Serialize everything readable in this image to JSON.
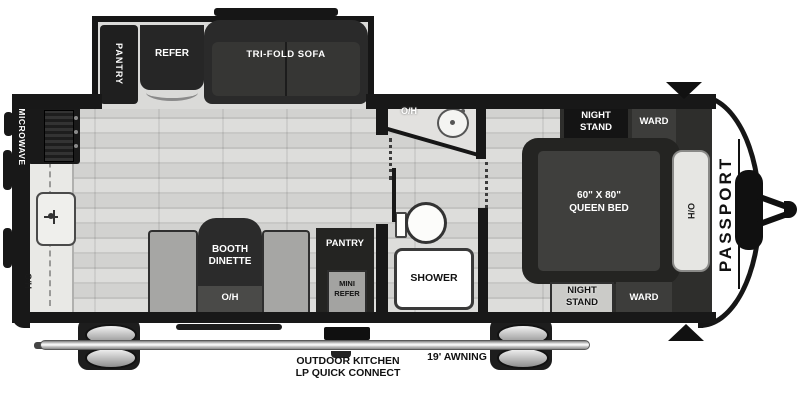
{
  "title": "Travel trailer floor plan",
  "exterior": {
    "brand": "PASSPORT",
    "awning": "19' AWNING"
  },
  "slideout": {
    "pantry": "PANTRY",
    "refer": "REFER",
    "sofa": "TRI-FOLD SOFA"
  },
  "kitchen": {
    "microwave": "MICROWAVE",
    "overhead": "O/H"
  },
  "dinette": {
    "line1": "BOOTH",
    "line2": "DINETTE",
    "overhead": "O/H"
  },
  "outdoor_kitchen": {
    "pantry": "PANTRY",
    "mini_refer_line1": "MINI",
    "mini_refer_line2": "REFER",
    "griddle": "GRIDDLE",
    "caption_line1": "OUTDOOR KITCHEN",
    "caption_line2": "LP QUICK CONNECT"
  },
  "bathroom": {
    "overhead": "O/H",
    "shower": "SHOWER"
  },
  "bedroom": {
    "night_stand_top_line1": "NIGHT",
    "night_stand_top_line2": "STAND",
    "ward_top": "WARD",
    "bed_line1": "60\" X 80\"",
    "bed_line2": "QUEEN BED",
    "overhead": "O/H",
    "night_stand_bottom_line1": "NIGHT",
    "night_stand_bottom_line2": "STAND",
    "ward_bottom": "WARD"
  },
  "colors": {
    "wall": "#181818",
    "furniture_dark": "#2b2b2b",
    "floor": "#d6d6d4",
    "counter": "#e9e9e6",
    "bench_gray": "#a6a6a4",
    "white": "#ffffff"
  }
}
